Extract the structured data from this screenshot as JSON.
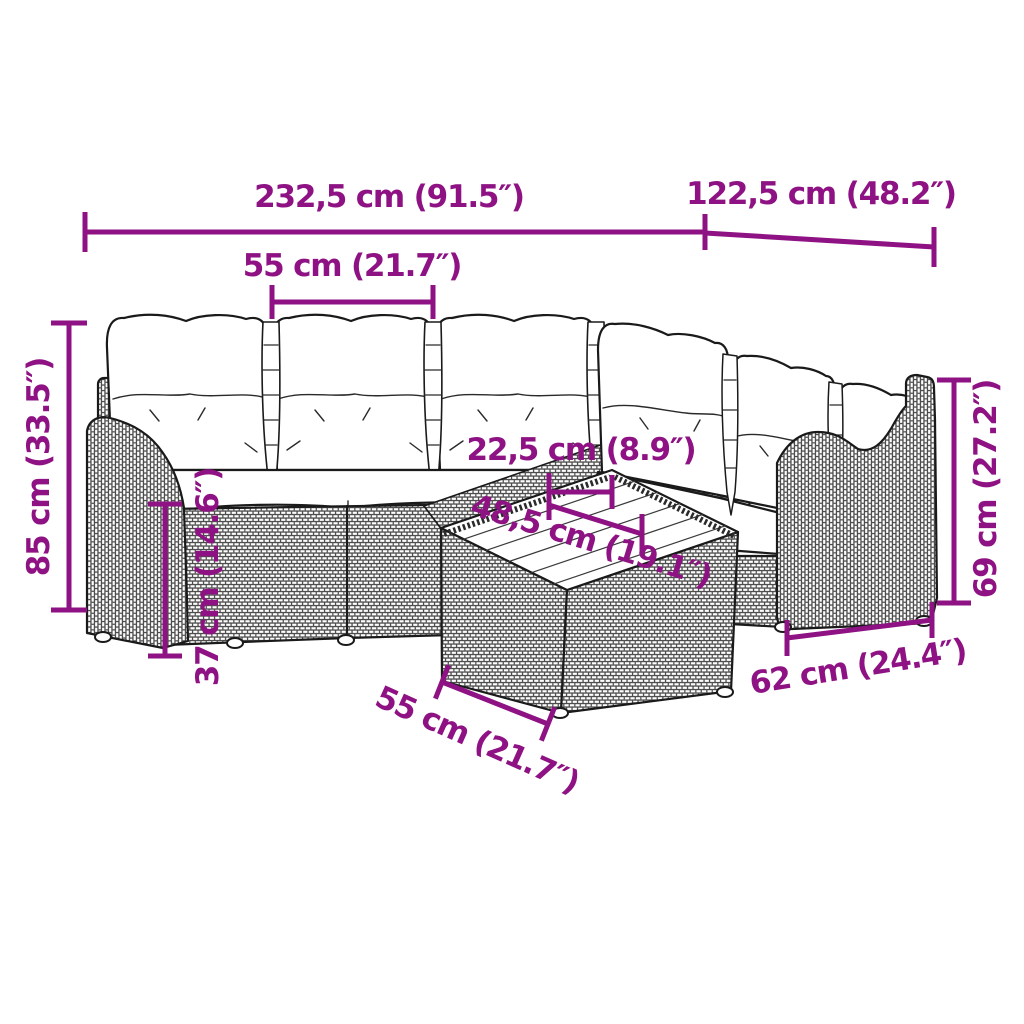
{
  "diagram": {
    "type": "product-dimension-diagram",
    "subject": "rattan garden lounge set with coffee table",
    "colors": {
      "accent": "#8E1283",
      "line_art": "#1a1a1a",
      "cushion": "#ffffff",
      "background": "#ffffff"
    },
    "dimensions": [
      {
        "id": "overall-width",
        "text": "232,5 cm (91.5″)"
      },
      {
        "id": "overall-depth",
        "text": "122,5 cm (48.2″)"
      },
      {
        "id": "seat-module-width",
        "text": "55 cm (21.7″)"
      },
      {
        "id": "overall-height",
        "text": "85 cm (33.5″)"
      },
      {
        "id": "seat-height",
        "text": "37 cm (14.6″)"
      },
      {
        "id": "table-clearance",
        "text": "22,5 cm (8.9″)"
      },
      {
        "id": "table-top-depth",
        "text": "48,5 cm (19.1″)"
      },
      {
        "id": "table-width",
        "text": "55 cm (21.7″)"
      },
      {
        "id": "armrest-section-depth",
        "text": "62 cm (24.4″)"
      },
      {
        "id": "armrest-height",
        "text": "69 cm (27.2″)"
      }
    ]
  }
}
